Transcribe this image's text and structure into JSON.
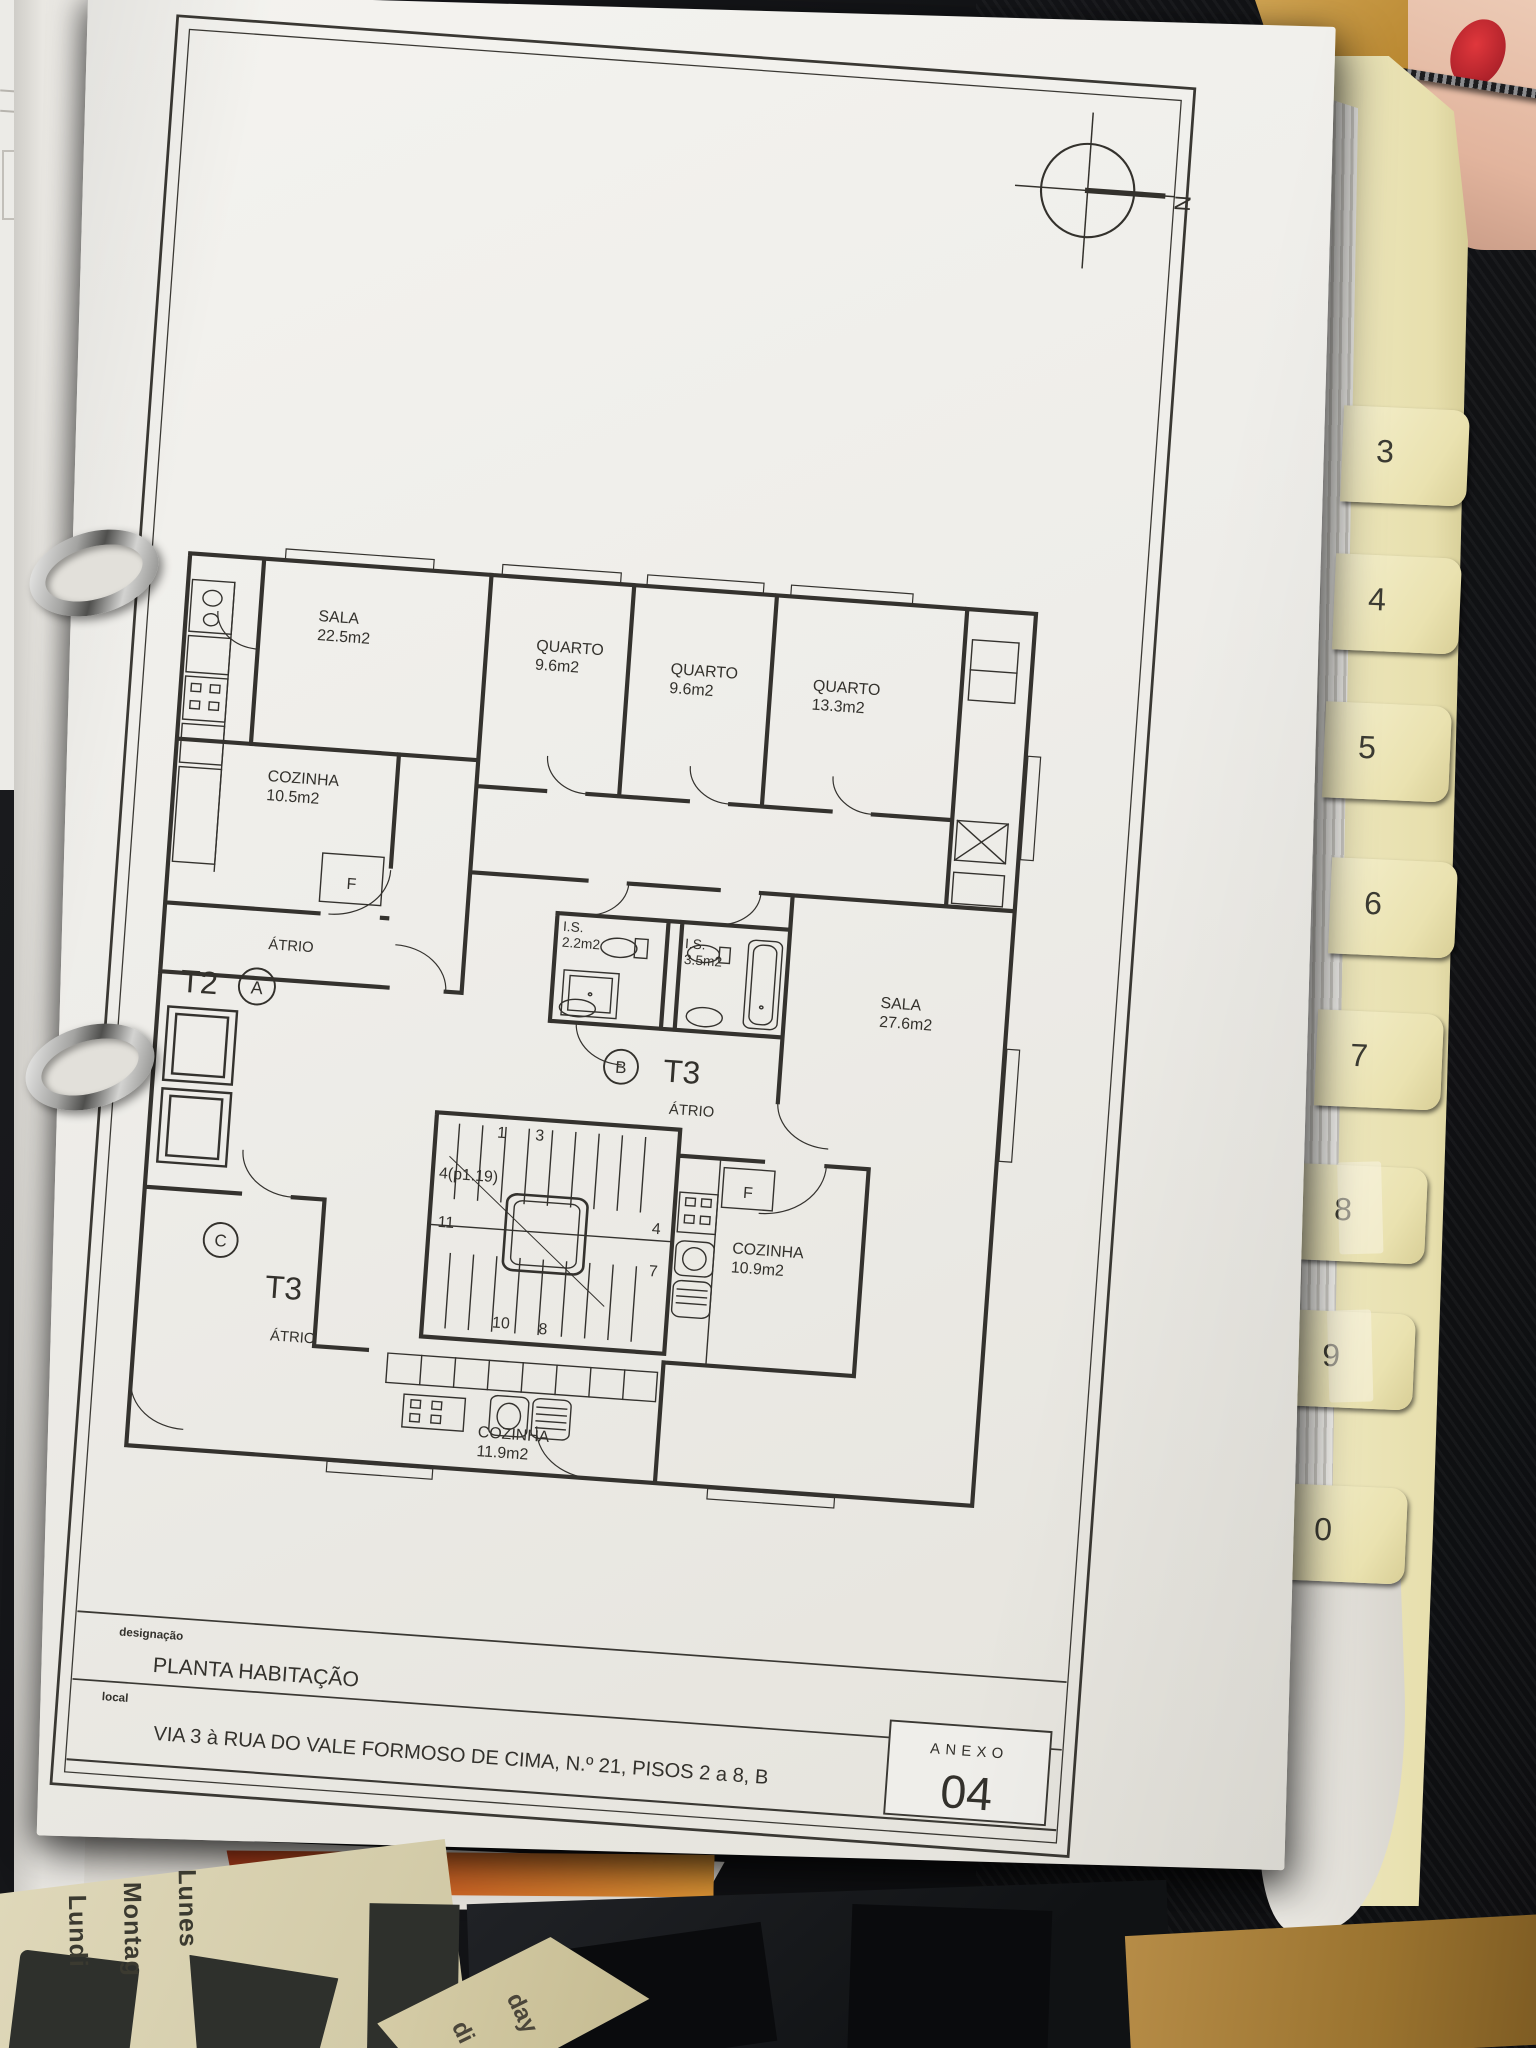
{
  "drawing": {
    "compass": {
      "north": "N"
    },
    "rooms": {
      "sala_a": {
        "name": "SALA",
        "area": "22.5m2"
      },
      "quarto_1": {
        "name": "QUARTO",
        "area": "9.6m2"
      },
      "quarto_2": {
        "name": "QUARTO",
        "area": "9.6m2"
      },
      "quarto_3": {
        "name": "QUARTO",
        "area": "13.3m2"
      },
      "cozinha_a": {
        "name": "COZINHA",
        "area": "10.5m2"
      },
      "is_a": {
        "name": "I.S.",
        "area": "2.2m2"
      },
      "is_b": {
        "name": "I.S.",
        "area": "3.5m2"
      },
      "sala_b": {
        "name": "SALA",
        "area": "27.6m2"
      },
      "cozinha_b": {
        "name": "COZINHA",
        "area": "10.9m2"
      },
      "cozinha_c": {
        "name": "COZINHA",
        "area": "11.9m2"
      }
    },
    "units": {
      "a": {
        "type": "T2",
        "letter": "A",
        "hall": "ÁTRIO"
      },
      "b": {
        "type": "T3",
        "letter": "B",
        "hall": "ÁTRIO"
      },
      "c": {
        "type": "T3",
        "letter": "C",
        "hall": "ÁTRIO"
      }
    },
    "appliance_label": "F",
    "stair_numbers": {
      "top_left": "1",
      "top_right": "3",
      "left_upper": "4(p1.19)",
      "left_lower": "11",
      "right_upper": "4",
      "right_lower": "7",
      "bottom_left": "10",
      "bottom_right": "8"
    },
    "title_block": {
      "designacao_label": "designação",
      "designacao": "PLANTA HABITAÇÃO",
      "local_label": "local",
      "local": "VIA 3 à RUA DO VALE FORMOSO DE CIMA, N.º 21, PISOS 2 a 8, B",
      "anexo_label": "ANEXO",
      "anexo_number": "04"
    }
  },
  "binder": {
    "tabs": [
      "3",
      "4",
      "5",
      "6",
      "7",
      "8",
      "9",
      "0"
    ]
  },
  "desk_items": {
    "calendar_day_words": [
      "Lundi",
      "Montag",
      "Lunes"
    ],
    "calendar_partial_words": [
      "di",
      "day"
    ]
  }
}
